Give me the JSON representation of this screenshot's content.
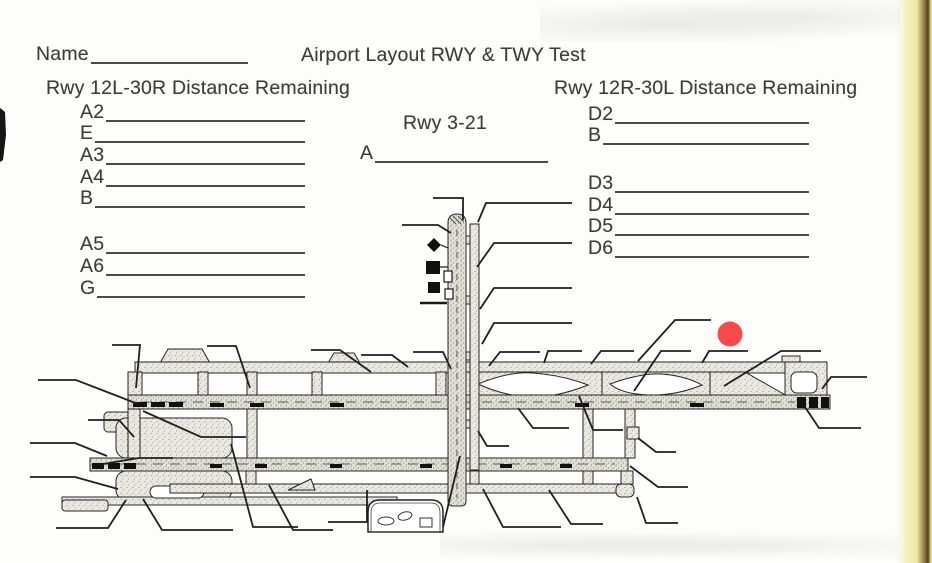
{
  "header": {
    "name_label": "Name",
    "name_value": "",
    "title": "Airport Layout RWY & TWY Test"
  },
  "sections": {
    "left": {
      "heading": "Rwy 12L-30R Distance Remaining",
      "items": [
        {
          "label": "A2",
          "value": ""
        },
        {
          "label": "E",
          "value": ""
        },
        {
          "label": "A3",
          "value": ""
        },
        {
          "label": "A4",
          "value": ""
        },
        {
          "label": "B",
          "value": ""
        },
        {
          "label": "A5",
          "value": ""
        },
        {
          "label": "A6",
          "value": ""
        },
        {
          "label": "G",
          "value": ""
        }
      ]
    },
    "center": {
      "heading": "Rwy 3-21",
      "items": [
        {
          "label": "A",
          "value": ""
        }
      ]
    },
    "right": {
      "heading": "Rwy 12R-30L Distance Remaining",
      "items": [
        {
          "label": "D2",
          "value": ""
        },
        {
          "label": "B",
          "value": ""
        },
        {
          "label": "D3",
          "value": ""
        },
        {
          "label": "D4",
          "value": ""
        },
        {
          "label": "D5",
          "value": ""
        },
        {
          "label": "D6",
          "value": ""
        }
      ]
    }
  },
  "diagram": {
    "marker_color": "#f9494b"
  },
  "scan_artifacts": {
    "paper_edge_yellow": "#f2ecae",
    "paper_edge_shadow": "#6e5a32",
    "edge_mark_color": "#151515"
  }
}
